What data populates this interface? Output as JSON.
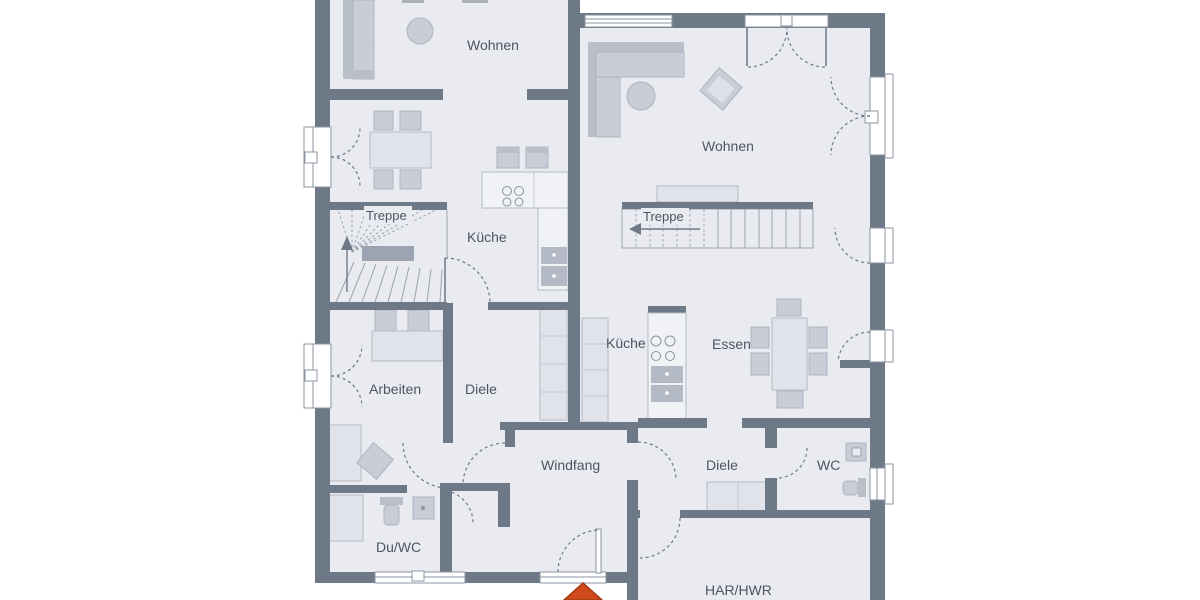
{
  "title": "Grundriss Erdgeschoss Doppelhaus",
  "labels": {
    "wohnen_left": "Wohnen",
    "treppe_left": "Treppe",
    "kueche_left": "Küche",
    "arbeiten": "Arbeiten",
    "diele_left": "Diele",
    "duwc": "Du/WC",
    "windfang": "Windfang",
    "wohnen_right": "Wohnen",
    "treppe_right": "Treppe",
    "kueche_right": "Küche",
    "essen": "Essen",
    "diele_right": "Diele",
    "wc": "WC",
    "har_hwr": "HAR/HWR"
  },
  "entrance": {
    "marker": "arrow",
    "direction": "up"
  },
  "stairs": {
    "left_arrow_direction": "up",
    "right_arrow_direction": "left"
  },
  "colors": {
    "floor": "#e9ebf0",
    "wall": "#6e7988",
    "accent": "#d0491b",
    "text": "#4d5564"
  }
}
